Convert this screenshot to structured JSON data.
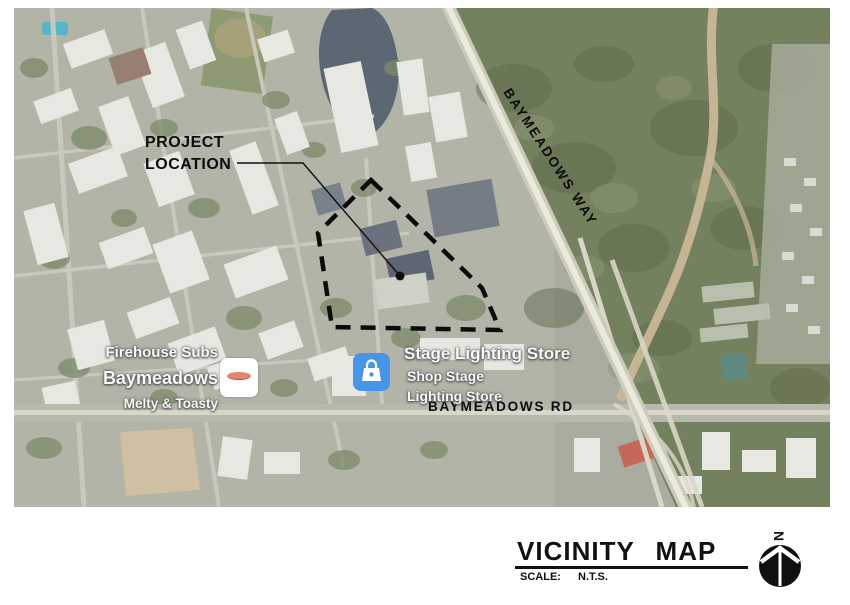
{
  "map": {
    "annotations": {
      "project_label": {
        "line1": "PROJECT",
        "line2": "LOCATION"
      },
      "road_way": "BAYMEADOWS WAY",
      "road_rd": "BAYMEADOWS RD"
    },
    "pois": {
      "firehouse": {
        "name_line1": "Firehouse Subs",
        "name_line2": "Baymeadows",
        "tagline": "Melty & Toasty",
        "icon": "firehouse-logo-icon"
      },
      "stage": {
        "name": "Stage Lighting Store",
        "detail_line1": "Shop Stage",
        "detail_line2": "Lighting Store",
        "icon": "shopping-bag-icon",
        "icon_color": "#4795e8"
      }
    }
  },
  "title_block": {
    "title": "VICINITY MAP",
    "scale_label": "SCALE:",
    "scale_value": "N.T.S.",
    "north_indicator": "N"
  },
  "colors": {
    "annotation_ink": "#0c0c0c",
    "poi_label": "#fbfbfb",
    "map_base": "#a9ac9f",
    "forest": "#74815f",
    "water": "#5c6774",
    "road": "#eceadb"
  }
}
